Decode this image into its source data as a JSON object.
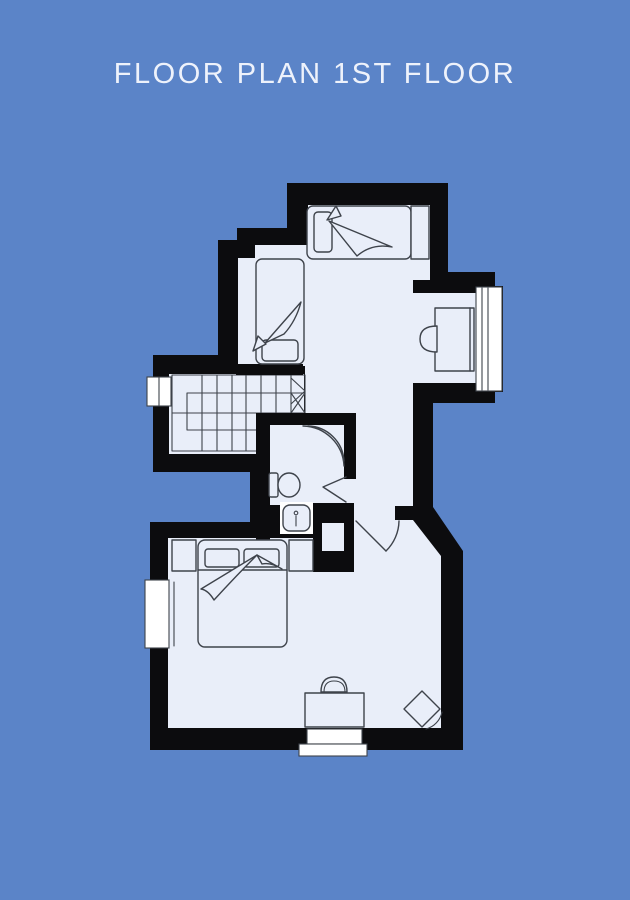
{
  "title": "FLOOR PLAN 1ST FLOOR",
  "colors": {
    "background": "#5b84c8",
    "floor": "#e9eef9",
    "wall": "#0c0c0e",
    "furniture_line": "#3e434b",
    "window": "#ffffff",
    "title_text": "#eef2fb"
  },
  "floor_plan": {
    "rooms": [
      "upper-bedroom",
      "desk-nook",
      "staircase",
      "bathroom",
      "hallway",
      "main-bedroom"
    ],
    "furniture": [
      "single-bed-top",
      "single-bed-left",
      "upper-desk",
      "upper-desk-chair",
      "stairs",
      "corner-shower",
      "toilet",
      "sink",
      "double-bed",
      "nightstand-left",
      "nightstand-right",
      "lower-desk",
      "lower-desk-chair",
      "stool"
    ],
    "windows": [
      "stairs-window",
      "nook-window",
      "bedroom-side-window",
      "bedroom-bottom-window"
    ],
    "doors": [
      "bathroom-door",
      "bedroom-door"
    ]
  }
}
